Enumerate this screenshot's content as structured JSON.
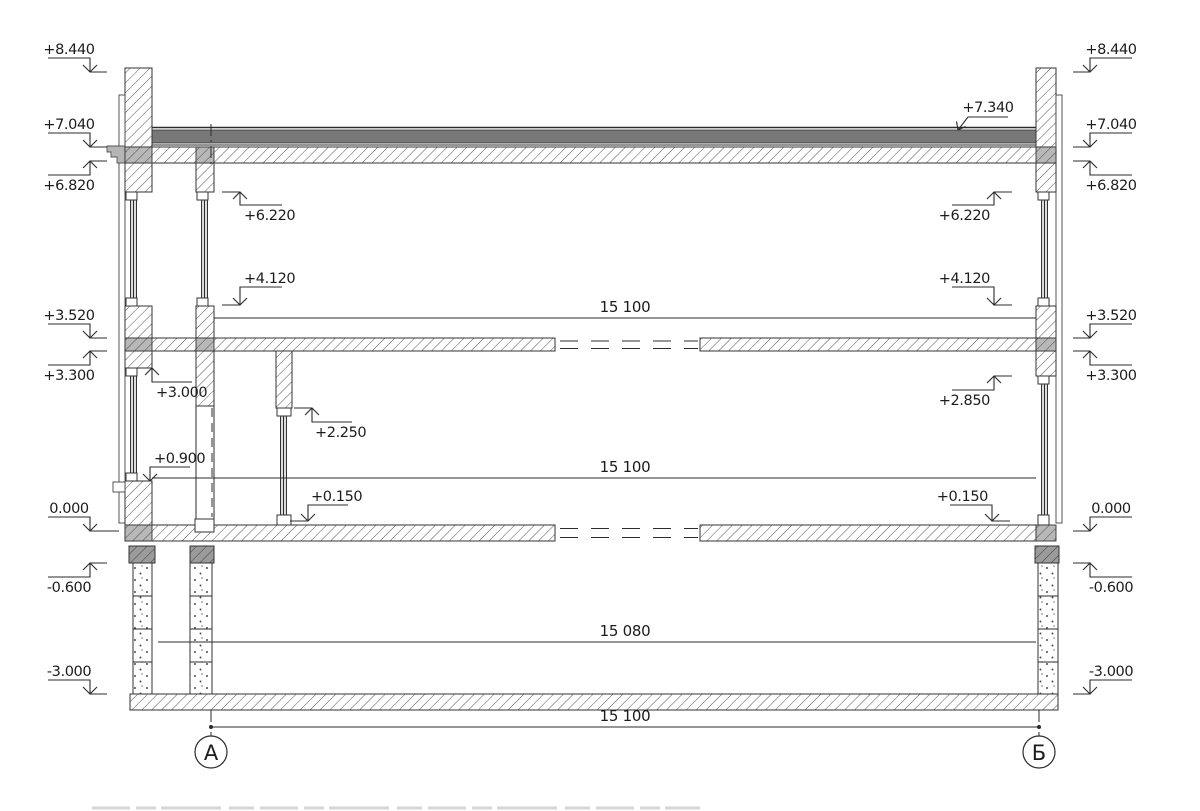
{
  "drawing": {
    "marks_left": [
      {
        "label": "+8.440"
      },
      {
        "label": "+7.040"
      },
      {
        "label": "+6.820"
      },
      {
        "label": "+3.520"
      },
      {
        "label": "+3.300"
      },
      {
        "label": "0.000"
      },
      {
        "label": "-0.600"
      },
      {
        "label": "-3.000"
      }
    ],
    "marks_right": [
      {
        "label": "+8.440"
      },
      {
        "label": "+7.040"
      },
      {
        "label": "+6.820"
      },
      {
        "label": "+3.520"
      },
      {
        "label": "+3.300"
      },
      {
        "label": "0.000"
      },
      {
        "label": "-0.600"
      },
      {
        "label": "-3.000"
      }
    ],
    "marks_interior": [
      {
        "label": "+7.340"
      },
      {
        "label": "+6.220"
      },
      {
        "label": "+4.120"
      },
      {
        "label": "+3.000"
      },
      {
        "label": "+0.900"
      },
      {
        "label": "+2.250"
      },
      {
        "label": "+0.150"
      },
      {
        "label": "+6.220"
      },
      {
        "label": "+4.120"
      },
      {
        "label": "+2.850"
      },
      {
        "label": "+0.150"
      }
    ],
    "dimensions": [
      {
        "label": "15 100"
      },
      {
        "label": "15 100"
      },
      {
        "label": "15 080"
      },
      {
        "label": "15 100"
      }
    ],
    "axes": [
      {
        "label": "А"
      },
      {
        "label": "Б"
      }
    ],
    "colors": {
      "line": "#2b2b2b",
      "roof_band": "#787878",
      "wall_cross_gray": "#b8b8b8",
      "foundation_cap_gray": "#a0a0a0",
      "flashing_gray": "#b5b5b5",
      "background": "#ffffff"
    }
  }
}
